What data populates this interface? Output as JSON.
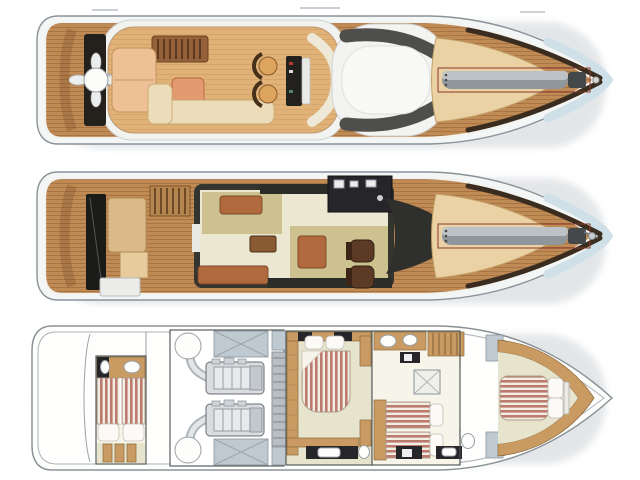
{
  "diagram": {
    "type": "yacht-deck-plans",
    "orientation": "bow-right",
    "views_top_to_bottom": [
      "flybridge-deck",
      "main-deck",
      "lower-deck"
    ]
  },
  "colors": {
    "background": "#ffffff",
    "hull_white": "#f4f6f6",
    "hull_outline": "#8a9298",
    "hull_blue": "#cfe0e8",
    "teak_deck": "#c08a55",
    "flybridge_floor": "#e0b277",
    "sunpad_cream": "#ead2a4",
    "sunpad_peach": "#eec096",
    "table_salmon": "#e49a70",
    "sofa_cream": "#ecdcba",
    "sofa_brown": "#b06a3d",
    "salon_floor": "#ece7d1",
    "rug_khaki": "#cdc28f",
    "helm_chair": "#5c3b26",
    "gray_bar": "#8f979c",
    "bar_outline": "#8a3b2e",
    "lower_floor": "#e7e4cd",
    "wood_furniture": "#c99a62",
    "mattress_stripe": "#bd7a6e",
    "mattress_base": "#f3eee4",
    "locker_blue": "#bfc9d2",
    "engine_gray": "#d9dde0"
  },
  "decks": [
    {
      "id": "flybridge-deck",
      "features": [
        "radar-mast",
        "satellite-dome",
        "aft-teak-deck",
        "grill-vents",
        "sunpad",
        "bar-table",
        "l-shaped-sofa",
        "helm-seats",
        "helm-console",
        "hardtop-sunroof",
        "bow-sunpad",
        "tender-crane-bar",
        "anchor-fitting"
      ]
    },
    {
      "id": "main-deck",
      "features": [
        "teak-swim-deck",
        "aft-bench",
        "transom-box",
        "flybridge-stairs",
        "salon-sofas",
        "coffee-table",
        "sideboard",
        "galley",
        "helm-chairs",
        "windshield",
        "bow-sunpad",
        "tender-crane-bar",
        "anchor-windlass"
      ]
    },
    {
      "id": "lower-deck",
      "features": [
        "crew-cabin-bunks",
        "crew-bathroom",
        "engine-room",
        "twin-engines",
        "mufflers",
        "fuel-tanks",
        "ladder",
        "master-cabin-double-bed",
        "master-vanity",
        "wardrobes",
        "twin-cabin-beds",
        "shower",
        "toilets",
        "staircase",
        "vip-bow-cabin-bed"
      ]
    }
  ]
}
